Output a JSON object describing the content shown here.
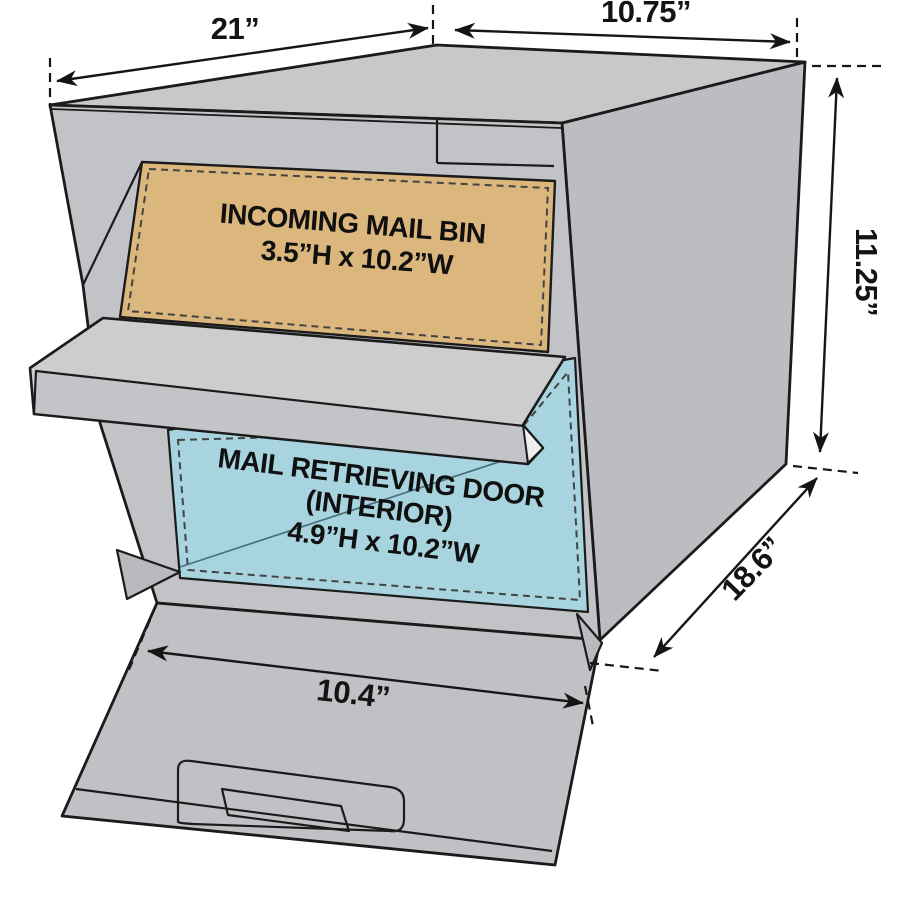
{
  "diagram": {
    "dimensions": {
      "top_left": "21”",
      "top_right": "10.75”",
      "height_right": "11.25”",
      "depth_right": "18.6”",
      "door_width": "10.4”"
    },
    "incoming_bin": {
      "line1": "INCOMING MAIL BIN",
      "line2": "3.5”H x 10.2”W"
    },
    "retrieving_door": {
      "line1": "MAIL RETRIEVING DOOR",
      "line2": "(INTERIOR)",
      "line3": "4.9”H x 10.2”W"
    },
    "colors": {
      "top_face": "#c6c8ca",
      "right_face": "#bbbdc0",
      "front_face": "#c1c3c6",
      "hood_top": "#cccdcf",
      "hood_front": "#c3c4c7",
      "hood_tip": "#efefef",
      "door_face": "#bfc1c4",
      "jamb": "#b8babd",
      "bin_tan": "#dcb77d",
      "door_blue": "#a8d4e0",
      "outline": "#1b1b1b",
      "dash": "#434343",
      "crease": "#47707c",
      "text": "#141414"
    }
  }
}
